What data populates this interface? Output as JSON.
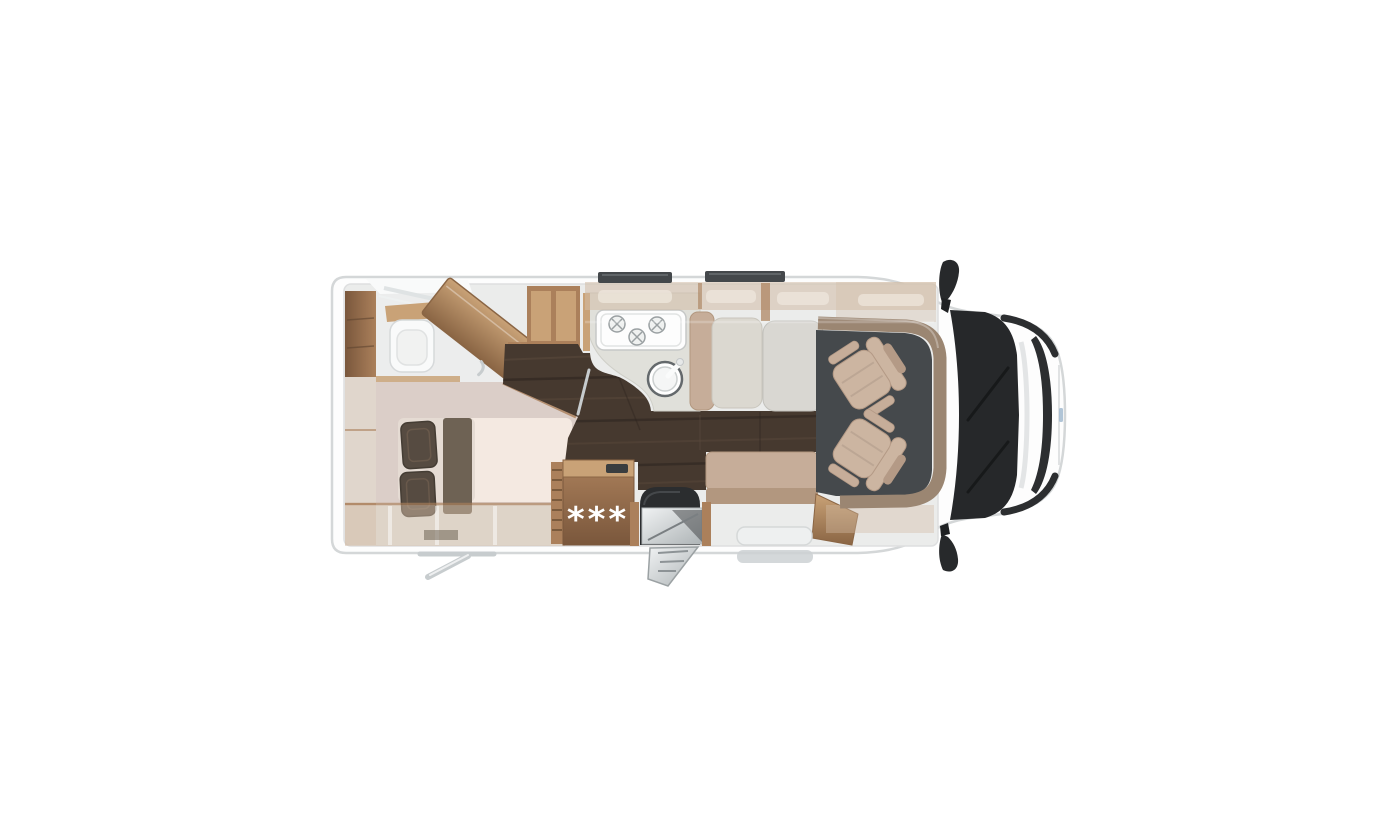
{
  "scene": {
    "type": "motorhome-floorplan-top-view",
    "orientation": "cab-on-right",
    "labels": {
      "heater_marker": "***"
    },
    "inventory": {
      "rooms": [
        "rear-bathroom-with-shower",
        "wardrobe",
        "rear-bed",
        "kitchen",
        "dinette",
        "driver-cab"
      ],
      "fixtures": [
        "toilet",
        "shower-head",
        "angled-wardrobe-cabinet",
        "bed-with-2-pillows",
        "kitchen-stove-3-burners",
        "round-sink",
        "forward-bench",
        "dinette-table",
        "side-bench",
        "heater-cabinet-with-marker",
        "entry-door-with-folding-step",
        "2-swivel-cab-seats",
        "windshield-with-wipers",
        "2-roof-skylights",
        "2-side-mirrors",
        "rear-exterior-step"
      ]
    }
  },
  "colors": {
    "bg": "#ffffff",
    "body": "#fdfdfd",
    "body-edge": "#d4d7d8",
    "interior": "#ebeceb",
    "interior-edge": "#dedfe0",
    "tan": "#d2bca6",
    "wood": "#ab805b",
    "wood-light": "#c9a277",
    "wood-dark": "#8a6544",
    "wood-deep": "#7a573c",
    "floor": "#46392f",
    "floor-light": "#5d4c3e",
    "floor-shadow": "#2d2520",
    "slate": "#45494c",
    "counter": "#e0e0da",
    "stove": "#fdfdfd",
    "steel": "#9aa0a2",
    "cushion": "#dbd8d0",
    "seat": "#c6ad99",
    "seat-dark": "#b2977f",
    "table": "#d9d7d2",
    "bed": "#dbcec8",
    "mattress": "#f4e9e1",
    "pillow": "#564b41",
    "runner": "#6e6254",
    "black": "#2b2d2f",
    "windshield": "#26282a",
    "chrome": "#c7ccce",
    "metal": "#d9dcdd",
    "white-fix": "#f9fafa",
    "skylight": "#44484b",
    "gray-door": "#cdd1d3",
    "cabseat": "#ccb5a1",
    "cabseat-dark": "#b49a86",
    "marker-text": "#ffffff"
  }
}
